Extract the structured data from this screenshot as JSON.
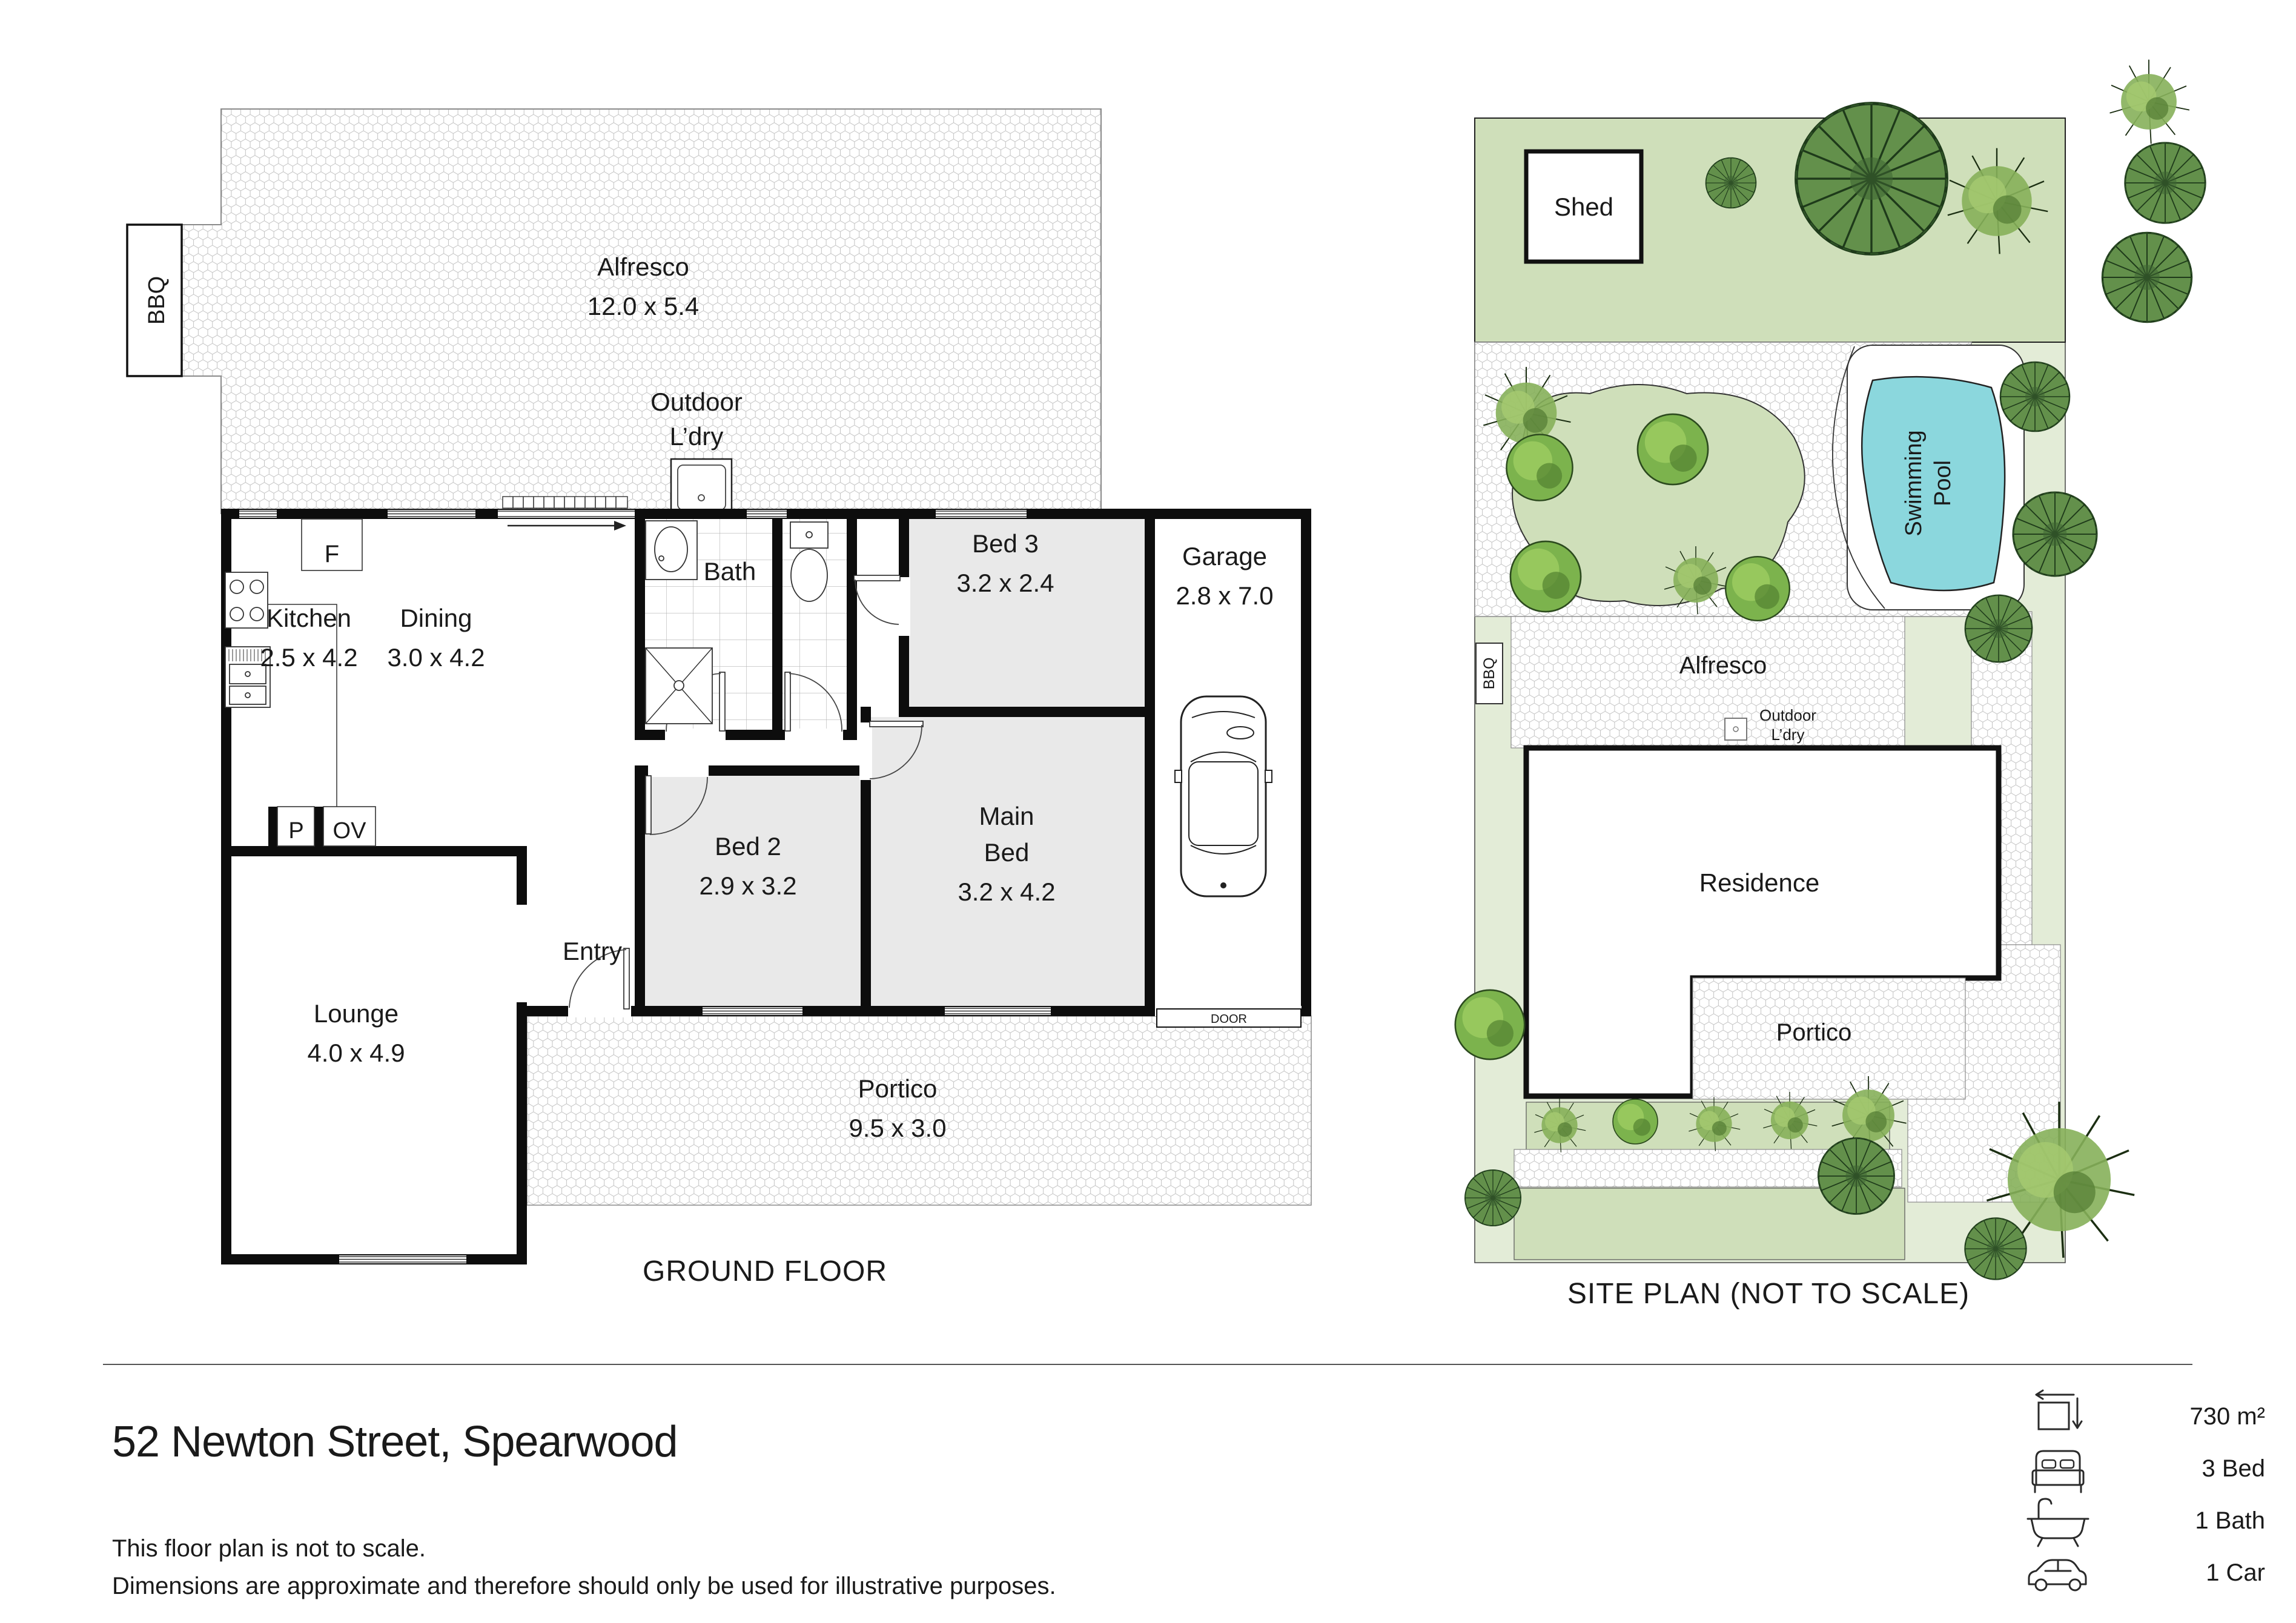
{
  "title": "52 Newton Street, Spearwood",
  "disclaimer_line1": "This floor plan is not to scale.",
  "disclaimer_line2": "Dimensions are approximate and therefore should only be used for illustrative purposes.",
  "floor_plan": {
    "caption": "GROUND FLOOR",
    "bbq": "BBQ",
    "alfresco": {
      "name": "Alfresco",
      "dims": "12.0 x 5.4"
    },
    "outdoor_ldry": {
      "line1": "Outdoor",
      "line2": "L’dry"
    },
    "kitchen": {
      "name": "Kitchen",
      "dims": "2.5 x 4.2"
    },
    "dining": {
      "name": "Dining",
      "dims": "3.0 x 4.2"
    },
    "bath": {
      "name": "Bath"
    },
    "bed3": {
      "name": "Bed 3",
      "dims": "3.2 x 2.4"
    },
    "garage": {
      "name": "Garage",
      "dims": "2.8 x 7.0"
    },
    "bed2": {
      "name": "Bed 2",
      "dims": "2.9 x 3.2"
    },
    "main_bed": {
      "name_line1": "Main",
      "name_line2": "Bed",
      "dims": "3.2 x 4.2"
    },
    "entry": {
      "name": "Entry"
    },
    "lounge": {
      "name": "Lounge",
      "dims": "4.0 x 4.9"
    },
    "portico": {
      "name": "Portico",
      "dims": "9.5 x 3.0"
    },
    "labels": {
      "fridge": "F",
      "pantry": "P",
      "oven": "OV",
      "garage_door": "DOOR"
    }
  },
  "site_plan": {
    "caption": "SITE PLAN (NOT TO SCALE)",
    "shed": "Shed",
    "bbq": "BBQ",
    "alfresco": "Alfresco",
    "outdoor_line1": "Outdoor",
    "outdoor_line2": "L’dry",
    "residence": "Residence",
    "portico": "Portico",
    "pool_line1": "Swimming",
    "pool_line2": "Pool"
  },
  "summary": {
    "area": "730 m²",
    "beds": "3 Bed",
    "baths": "1 Bath",
    "cars": "1 Car"
  },
  "colors": {
    "wall": "#0d0d0d",
    "room_gray": "#e9e9e9",
    "site_bg": "#e3ecd7",
    "site_green": "#cfdfba",
    "pool": "#8bd7dd"
  }
}
